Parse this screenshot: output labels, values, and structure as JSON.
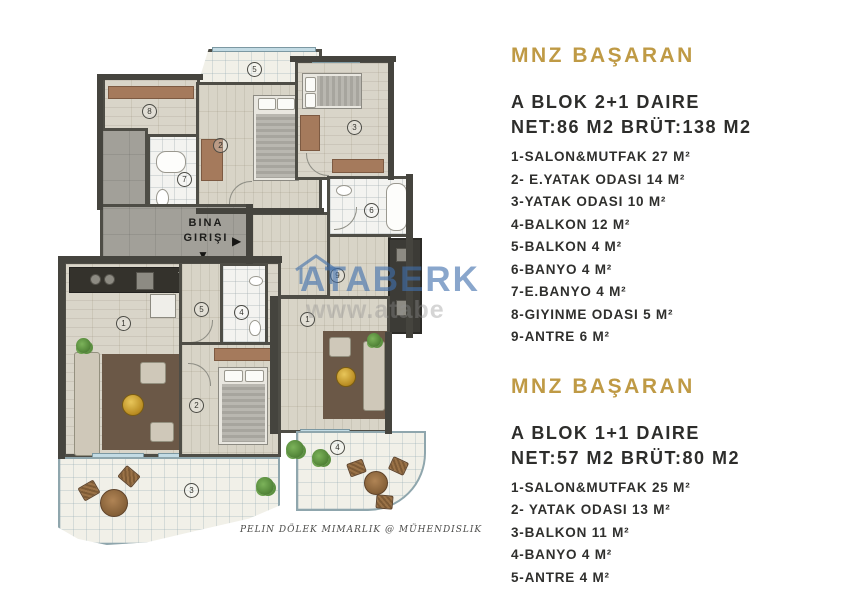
{
  "plan": {
    "entrance": {
      "line1": "BINA",
      "line2": "GIRIŞI",
      "arrow_right": "▶",
      "arrow_down": "▼"
    },
    "watermark": {
      "brand": "ATABERK",
      "url": "www.atabe"
    },
    "signature": "PELIN DÖLEK MIMARLIK @ MÜHENDISLIK",
    "numbers": {
      "balkon_top": "5",
      "giyinme": "8",
      "ebanyo": "7",
      "eyatak": "2",
      "yatak": "3",
      "banyo": "6",
      "antre": "9",
      "salon": "1",
      "balkon_right": "4",
      "salon_1p1": "1",
      "antre_1p1": "5",
      "banyo_1p1": "4",
      "yatak_1p1": "2",
      "balkon_1p1": "3"
    }
  },
  "panel": {
    "accent_color": "#bf9a45",
    "sections": [
      {
        "brand": "MNZ BAŞARAN",
        "title": "A BLOK 2+1 DAIRE",
        "area": "NET:86 M2 BRÜT:138 M2",
        "rooms": [
          "1-SALON&MUTFAK 27 M²",
          "2- E.YATAK ODASI 14 M²",
          "3-YATAK ODASI 10 M²",
          "4-BALKON 12 M²",
          "5-BALKON 4 M²",
          "6-BANYO 4 M²",
          "7-E.BANYO 4 M²",
          "8-GIYINME ODASI 5 M²",
          "9-ANTRE 6 M²"
        ]
      },
      {
        "brand": "MNZ BAŞARAN",
        "title": "A BLOK 1+1 DAIRE",
        "area": "NET:57 M2 BRÜT:80 M2",
        "rooms": [
          "1-SALON&MUTFAK 25 M²",
          "2- YATAK ODASI 13 M²",
          "3-BALKON 11 M²",
          "4-BANYO 4 M²",
          "5-ANTRE 4 M²"
        ]
      }
    ]
  }
}
